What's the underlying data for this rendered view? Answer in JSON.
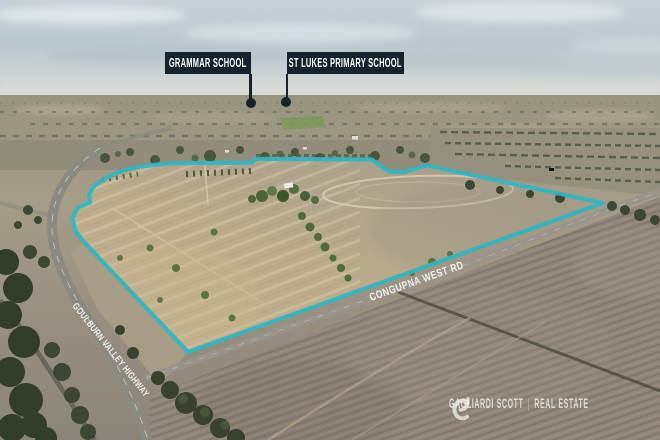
{
  "callouts": [
    {
      "id": "grammar-school",
      "label": "GRAMMAR SCHOOL"
    },
    {
      "id": "st-lukes-primary-school",
      "label": "ST LUKES PRIMARY SCHOOL"
    }
  ],
  "road_labels": [
    {
      "id": "goulburn-valley-highway",
      "label": "GOULBURN VALLEY HIGHWAY"
    },
    {
      "id": "congupna-west-rd",
      "label": "CONGUPNA WEST RD"
    }
  ],
  "watermark": {
    "logo": "gagliardi-scott-g-monogram",
    "brand": "GAGLIARDI SCOTT",
    "divider": "|",
    "division": "REAL ESTATE"
  },
  "colors": {
    "boundary_line": "#2fb6c1",
    "callout_box": "#16222c",
    "callout_text": "#ffffff",
    "road_label_text": "#f4f3ef",
    "watermark_text": "#f3f2ee"
  }
}
